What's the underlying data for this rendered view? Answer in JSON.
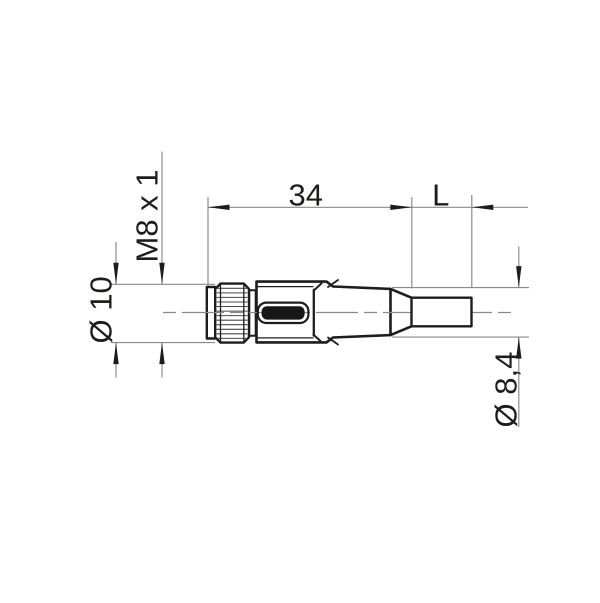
{
  "colors": {
    "outline": "#1d1d1b",
    "dimension-line": "#898989",
    "text": "#1d1d1b",
    "background": "#ffffff",
    "label-fill": "#161616"
  },
  "drawing": {
    "dimensions": {
      "thread": "M8 x 1",
      "nut_diameter": "Ø 10",
      "body_length": "34",
      "cable_length": "L",
      "boot_diameter": "Ø 8,4"
    }
  }
}
